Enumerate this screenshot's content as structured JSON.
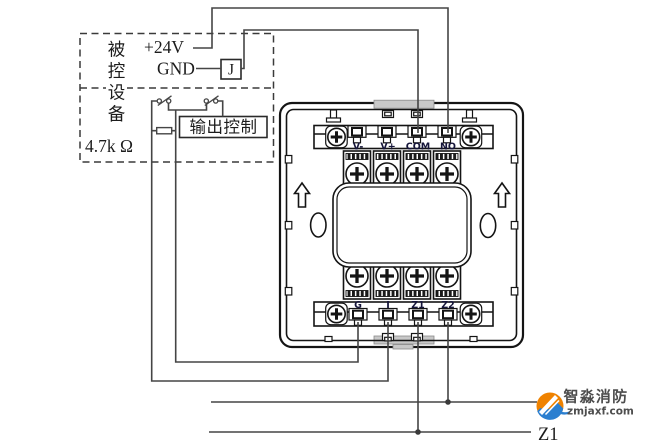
{
  "diagram": {
    "device_box": {
      "vertical_label": "被控设备",
      "chars": [
        "被",
        "控",
        "设",
        "备"
      ],
      "power_label": "+24V",
      "ground_label": "GND",
      "relay_label": "J",
      "output_control_label": "输出控制",
      "resistor_label": "4.7k Ω"
    },
    "module": {
      "top_terminals": [
        "V-",
        "V+",
        "COM",
        "NO"
      ],
      "bottom_terminals": [
        "G",
        "I",
        "Z1",
        "Z2"
      ]
    },
    "bus": {
      "z1_label": "Z1"
    },
    "logo": {
      "brand": "智淼消防",
      "site": "zmjaxf.com"
    },
    "colors": {
      "wire": "#454545",
      "line": "#141414",
      "terminal_label": "#15153a",
      "logo_orange": "#ef8200",
      "logo_blue": "#2b7fd0",
      "logo_text": "#4d4d4d"
    }
  }
}
